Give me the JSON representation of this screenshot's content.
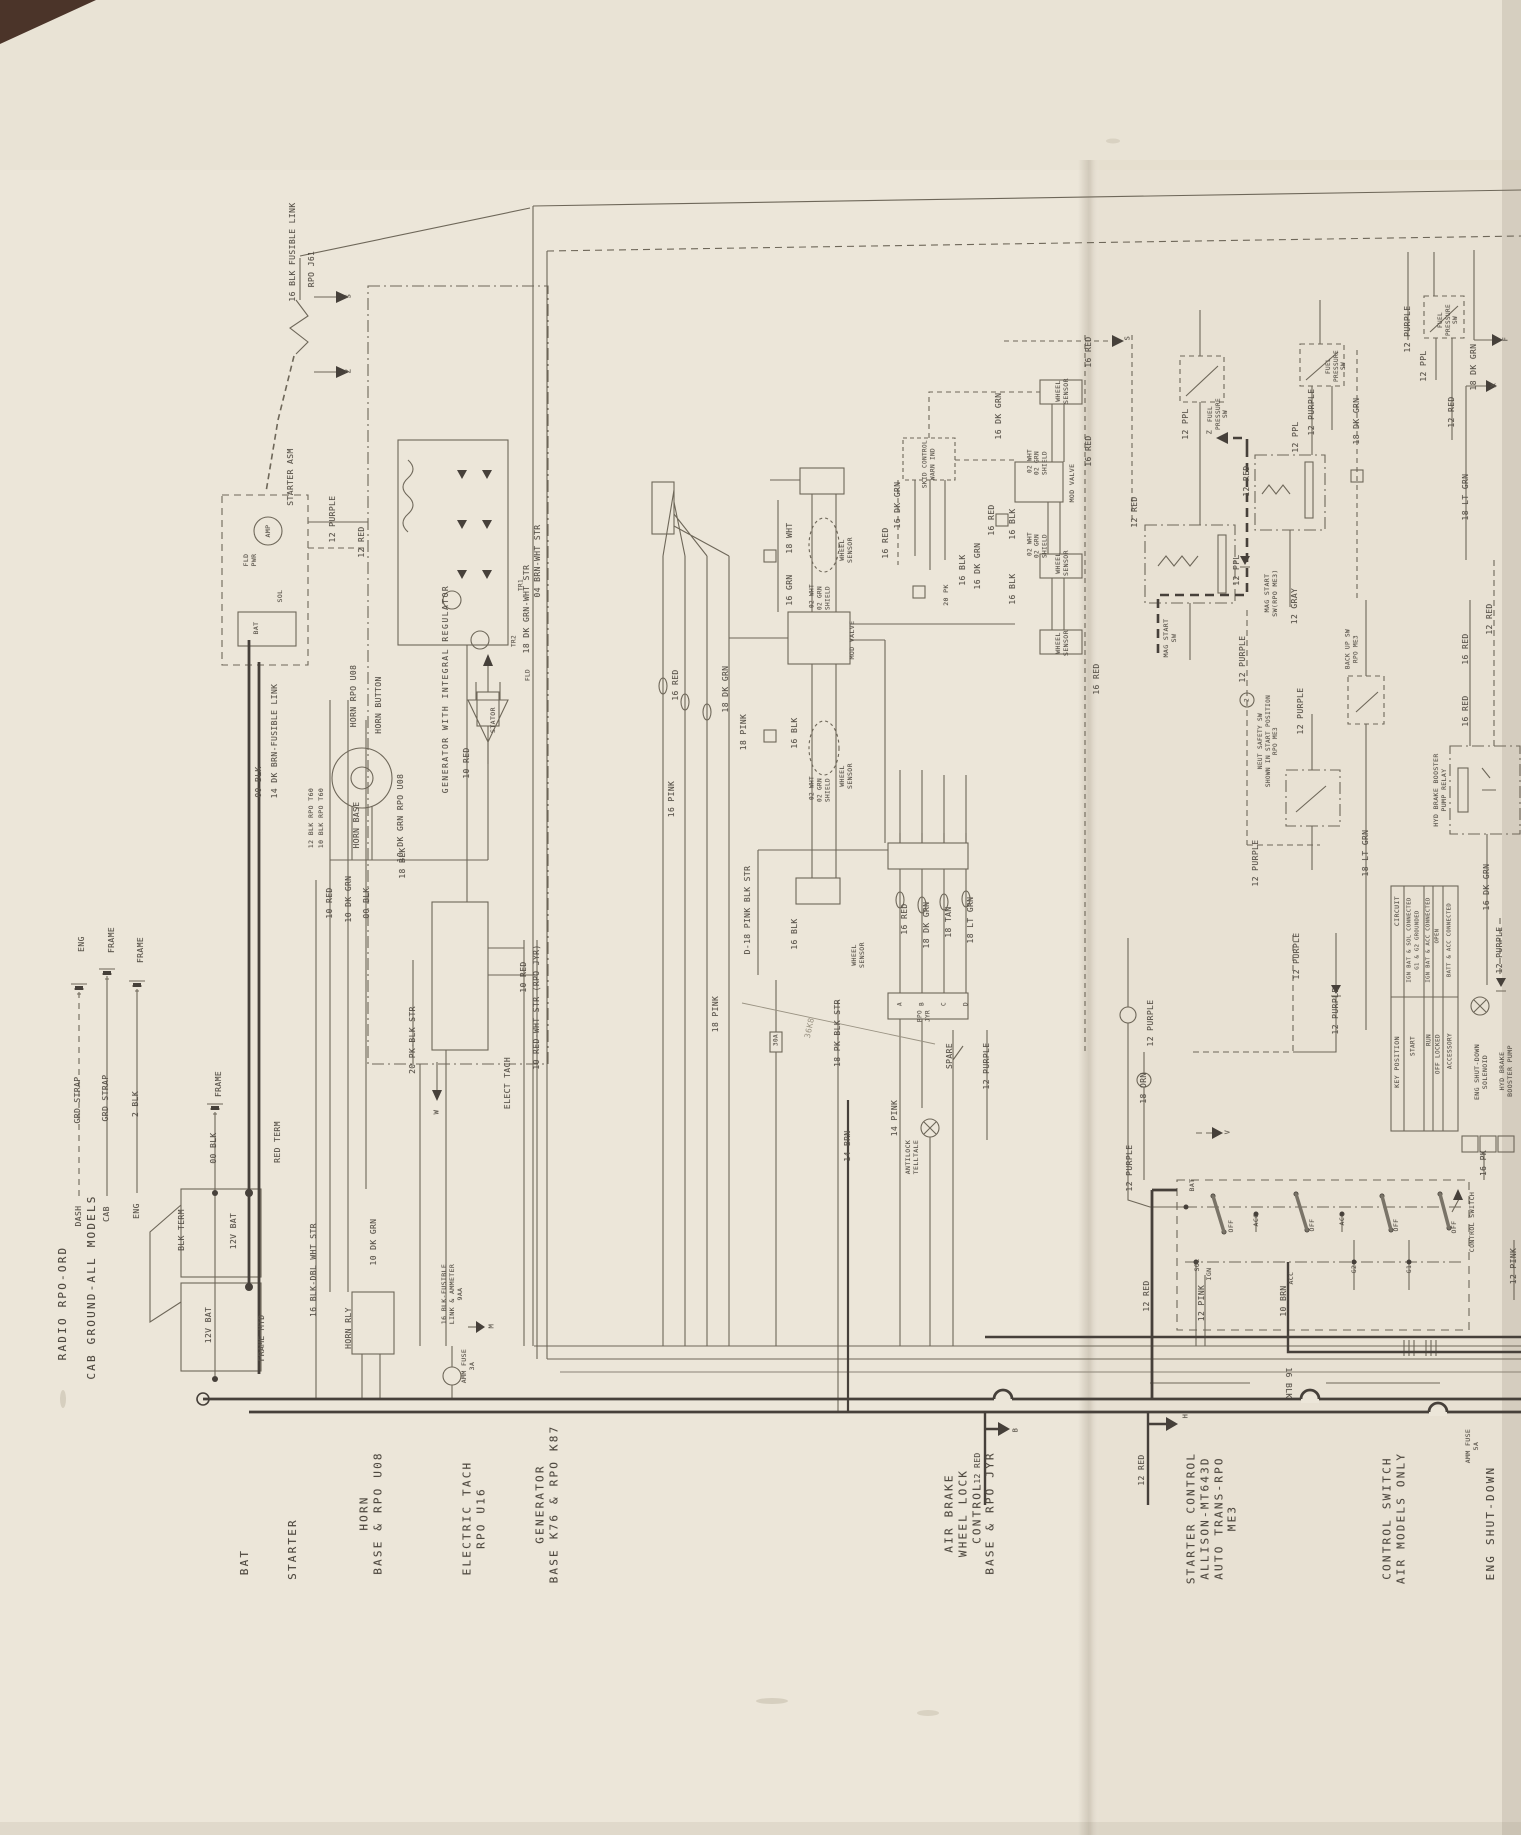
{
  "page": {
    "paper_color": "#ece6d9",
    "line_color": "#6e6759",
    "heavy_line_color": "#46403a",
    "text_color": "#59534a"
  },
  "key_table": {
    "placed_cells": [
      {
        "t": "CIRCUIT",
        "x": 1397,
        "y": 911,
        "s": 6.5,
        "n": "key-table-header"
      },
      {
        "t": "KEY POSITION",
        "x": 1397,
        "y": 1062,
        "s": 6.5,
        "n": "key-table-header"
      },
      {
        "t": "IGN BAT & SOL CONNECTED",
        "x": 1410,
        "y": 940,
        "s": 5.5,
        "n": "key-table-cell"
      },
      {
        "t": "G1 & G2 GROUNDED",
        "x": 1418,
        "y": 940,
        "s": 5.5,
        "n": "key-table-cell"
      },
      {
        "t": "START",
        "x": 1413,
        "y": 1046,
        "s": 6,
        "n": "key-table-cell"
      },
      {
        "t": "IGN BAT & ACC CONNECTED",
        "x": 1429,
        "y": 940,
        "s": 5.5,
        "n": "key-table-cell"
      },
      {
        "t": "RUN",
        "x": 1429,
        "y": 1040,
        "s": 6,
        "n": "key-table-cell"
      },
      {
        "t": "OPEN",
        "x": 1438,
        "y": 936,
        "s": 5.5,
        "n": "key-table-cell"
      },
      {
        "t": "OFF LOCKED",
        "x": 1438,
        "y": 1054,
        "s": 6,
        "n": "key-table-cell"
      },
      {
        "t": "BATT & ACC CONNECTED",
        "x": 1450,
        "y": 940,
        "s": 5.5,
        "n": "key-table-cell"
      },
      {
        "t": "ACCESSORY",
        "x": 1450,
        "y": 1051,
        "s": 6,
        "n": "key-table-cell"
      }
    ]
  },
  "labels": [
    {
      "t": "RADIO RPO-ORD",
      "x": 63,
      "y": 1303,
      "c": "big",
      "n": "section-label"
    },
    {
      "t": "CAB GROUND-ALL MODELS",
      "x": 92,
      "y": 1287,
      "c": "big",
      "n": "section-label"
    },
    {
      "t": "BAT",
      "x": 245,
      "y": 1562,
      "c": "big",
      "n": "section-label"
    },
    {
      "t": "STARTER",
      "x": 293,
      "y": 1549,
      "c": "big",
      "n": "section-label"
    },
    {
      "t": "HORN\nBASE & RPO U08",
      "x": 371,
      "y": 1513,
      "c": "big",
      "n": "section-label"
    },
    {
      "t": "ELECTRIC TACH\nRPO U16",
      "x": 474,
      "y": 1518,
      "c": "big",
      "n": "section-label"
    },
    {
      "t": "GENERATOR\nBASE K76 & RPO K87",
      "x": 547,
      "y": 1504,
      "c": "big",
      "n": "section-label"
    },
    {
      "t": "AIR BRAKE\nWHEEL LOCK\nCONTROL\nBASE & RPO JYR",
      "x": 970,
      "y": 1513,
      "c": "big",
      "n": "section-label"
    },
    {
      "t": "STARTER CONTROL\nALLISON-MT643D\nAUTO TRANS-RPO\nME3",
      "x": 1212,
      "y": 1518,
      "c": "big",
      "n": "section-label"
    },
    {
      "t": "CONTROL SWITCH\nAIR MODELS ONLY",
      "x": 1394,
      "y": 1518,
      "c": "big",
      "n": "section-label"
    },
    {
      "t": "ENG SHUT-DOWN",
      "x": 1491,
      "y": 1523,
      "c": "big",
      "n": "section-label"
    },
    {
      "t": "DASH",
      "x": 79,
      "y": 1216,
      "n": "legend-label"
    },
    {
      "t": "GRD STRAP",
      "x": 78,
      "y": 1100,
      "n": "legend-label"
    },
    {
      "t": "ENG",
      "x": 82,
      "y": 944,
      "n": "legend-label"
    },
    {
      "t": "CAB",
      "x": 107,
      "y": 1214,
      "n": "legend-label"
    },
    {
      "t": "GRD STRAP",
      "x": 106,
      "y": 1098,
      "n": "legend-label"
    },
    {
      "t": "FRAME",
      "x": 112,
      "y": 940,
      "n": "legend-label"
    },
    {
      "t": "ENG",
      "x": 137,
      "y": 1211,
      "n": "legend-label"
    },
    {
      "t": "2 BLK",
      "x": 136,
      "y": 1104,
      "n": "legend-label"
    },
    {
      "t": "FRAME",
      "x": 141,
      "y": 950,
      "n": "legend-label"
    },
    {
      "t": "00 BLK",
      "x": 214,
      "y": 1148,
      "n": "legend-label"
    },
    {
      "t": "FRAME",
      "x": 219,
      "y": 1084,
      "n": "legend-label"
    },
    {
      "t": "BLK TERM",
      "x": 182,
      "y": 1230
    },
    {
      "t": "12V BAT",
      "x": 234,
      "y": 1231
    },
    {
      "t": "12V BAT",
      "x": 209,
      "y": 1325
    },
    {
      "t": "FRAME MTD",
      "x": 262,
      "y": 1338
    },
    {
      "t": "RED TERM",
      "x": 278,
      "y": 1142
    },
    {
      "t": "10 RED",
      "x": 330,
      "y": 903
    },
    {
      "t": "10 DK GRN",
      "x": 349,
      "y": 899
    },
    {
      "t": "00 BLK",
      "x": 367,
      "y": 903
    },
    {
      "t": "16 BLK FUSIBLE LINK",
      "x": 293,
      "y": 252
    },
    {
      "t": "RPO J61",
      "x": 312,
      "y": 269
    },
    {
      "t": "STARTER ASM",
      "x": 291,
      "y": 477
    },
    {
      "t": "FLD\nPWR",
      "x": 250,
      "y": 560,
      "s": 6.5
    },
    {
      "t": "AMP",
      "x": 268,
      "y": 531,
      "s": 6.5,
      "n": "component-label"
    },
    {
      "t": "BAT",
      "x": 256,
      "y": 628,
      "s": 6.5
    },
    {
      "t": "SOL",
      "x": 280,
      "y": 596,
      "s": 6.5
    },
    {
      "t": "12 PURPLE",
      "x": 333,
      "y": 519
    },
    {
      "t": "12 RED",
      "x": 362,
      "y": 542
    },
    {
      "t": "00 BLK",
      "x": 259,
      "y": 782
    },
    {
      "t": "14 DK BRN-FUSIBLE LINK",
      "x": 275,
      "y": 741
    },
    {
      "t": "HORN RPO U08",
      "x": 354,
      "y": 696
    },
    {
      "t": "HORN BUTTON",
      "x": 379,
      "y": 705
    },
    {
      "t": "HORN BASE",
      "x": 357,
      "y": 825
    },
    {
      "t": "12 BLK RPO T60",
      "x": 311,
      "y": 818,
      "s": 6.5
    },
    {
      "t": "10 BLK RPO T60",
      "x": 321,
      "y": 818,
      "s": 6.5
    },
    {
      "t": "10 DK GRN RPO U08",
      "x": 401,
      "y": 818
    },
    {
      "t": "18 BLK",
      "x": 403,
      "y": 863
    },
    {
      "t": "GENERATOR WITH INTEGRAL REGULATOR",
      "x": 446,
      "y": 689,
      "ls": 1.5,
      "n": "component-label"
    },
    {
      "t": "TR1",
      "x": 521,
      "y": 585,
      "s": 6,
      "n": "component-label"
    },
    {
      "t": "TR2",
      "x": 514,
      "y": 641,
      "s": 6,
      "n": "component-label"
    },
    {
      "t": "FLD",
      "x": 528,
      "y": 675,
      "s": 6,
      "n": "component-label"
    },
    {
      "t": "STATOR",
      "x": 493,
      "y": 720,
      "s": 6.5,
      "n": "component-label"
    },
    {
      "t": "10 RED",
      "x": 467,
      "y": 763
    },
    {
      "t": "ELECT TACH",
      "x": 508,
      "y": 1083,
      "n": "component-label"
    },
    {
      "t": "20 PK-BLK STR",
      "x": 413,
      "y": 1040
    },
    {
      "t": "16 BLK-FUSIBLE\nLINK & AMMETER\n9AA",
      "x": 452,
      "y": 1294,
      "s": 6.5
    },
    {
      "t": "AMM FUSE\n3A",
      "x": 468,
      "y": 1366,
      "s": 6.5
    },
    {
      "t": "16 BLK-DBL WHT STR",
      "x": 314,
      "y": 1270
    },
    {
      "t": "10 DK GRN",
      "x": 374,
      "y": 1242
    },
    {
      "t": "HORN RLY",
      "x": 349,
      "y": 1328,
      "n": "component-label"
    },
    {
      "t": "18 DK GRN-WHT STR",
      "x": 527,
      "y": 609
    },
    {
      "t": "04 BRN-WHT STR",
      "x": 538,
      "y": 561
    },
    {
      "t": "D-18 PINK BLK STR",
      "x": 748,
      "y": 910
    },
    {
      "t": "16 PINK",
      "x": 672,
      "y": 799
    },
    {
      "t": "18 PINK",
      "x": 744,
      "y": 732
    },
    {
      "t": "18 PINK",
      "x": 716,
      "y": 1014
    },
    {
      "t": "16 RED",
      "x": 676,
      "y": 685
    },
    {
      "t": "18 DK GRN",
      "x": 726,
      "y": 689
    },
    {
      "t": "16 GRN",
      "x": 790,
      "y": 590
    },
    {
      "t": "18 WHT",
      "x": 790,
      "y": 538
    },
    {
      "t": "02 WHT",
      "x": 812,
      "y": 596,
      "s": 6
    },
    {
      "t": "02 GRN\nSHIELD",
      "x": 824,
      "y": 598,
      "s": 6
    },
    {
      "t": "WHEEL\nSENSOR",
      "x": 846,
      "y": 550,
      "s": 6.5,
      "n": "component-label"
    },
    {
      "t": "MOD VALVE",
      "x": 852,
      "y": 640,
      "s": 6.5,
      "n": "component-label"
    },
    {
      "t": "02 WHT",
      "x": 812,
      "y": 788,
      "s": 6
    },
    {
      "t": "02 GRN\nSHIELD",
      "x": 824,
      "y": 790,
      "s": 6
    },
    {
      "t": "WHEEL\nSENSOR",
      "x": 846,
      "y": 776,
      "s": 6.5,
      "n": "component-label"
    },
    {
      "t": "16 BLK",
      "x": 795,
      "y": 733
    },
    {
      "t": "16 BLK",
      "x": 795,
      "y": 934
    },
    {
      "t": "WHEEL\nSENSOR",
      "x": 858,
      "y": 955,
      "s": 6.5,
      "n": "component-label"
    },
    {
      "t": "16 RED",
      "x": 1089,
      "y": 451
    },
    {
      "t": "16 RED",
      "x": 1097,
      "y": 679
    },
    {
      "t": "16 RED",
      "x": 1089,
      "y": 352
    },
    {
      "t": "12 RED",
      "x": 1135,
      "y": 512
    },
    {
      "t": "16 DK GRN",
      "x": 898,
      "y": 505
    },
    {
      "t": "16 DK GRN",
      "x": 999,
      "y": 416
    },
    {
      "t": "SKID CONTROL\nWARN IND",
      "x": 929,
      "y": 464,
      "s": 6,
      "n": "component-label"
    },
    {
      "t": "20 PK",
      "x": 946,
      "y": 595,
      "s": 6.5
    },
    {
      "t": "16 BLK",
      "x": 963,
      "y": 570
    },
    {
      "t": "16 DK GRN",
      "x": 978,
      "y": 566
    },
    {
      "t": "16 RED",
      "x": 886,
      "y": 543
    },
    {
      "t": "16 RED",
      "x": 992,
      "y": 520
    },
    {
      "t": "16 BLK",
      "x": 1013,
      "y": 524
    },
    {
      "t": "16 BLK",
      "x": 1013,
      "y": 589
    },
    {
      "t": "MOD VALVE",
      "x": 1072,
      "y": 483,
      "s": 6.5,
      "n": "component-label"
    },
    {
      "t": "WHEEL\nSENSOR",
      "x": 1062,
      "y": 391,
      "s": 6.5,
      "n": "component-label"
    },
    {
      "t": "02 WHT",
      "x": 1030,
      "y": 461,
      "s": 6
    },
    {
      "t": "02 GRN\nSHIELD",
      "x": 1041,
      "y": 463,
      "s": 6
    },
    {
      "t": "02 WHT",
      "x": 1030,
      "y": 544,
      "s": 6
    },
    {
      "t": "02 GRN\nSHIELD",
      "x": 1041,
      "y": 546,
      "s": 6
    },
    {
      "t": "WHEEL\nSENSOR",
      "x": 1062,
      "y": 563,
      "s": 6.5,
      "n": "component-label"
    },
    {
      "t": "WHEEL\nSENSOR",
      "x": 1062,
      "y": 643,
      "s": 6.5,
      "n": "component-label"
    },
    {
      "t": "12 PPL",
      "x": 1186,
      "y": 424
    },
    {
      "t": "FUEL\nPRESSURE\nSW",
      "x": 1218,
      "y": 414,
      "s": 6,
      "n": "component-label"
    },
    {
      "t": "FUEL\nPRESSURE\nSW",
      "x": 1336,
      "y": 366,
      "s": 6,
      "n": "component-label"
    },
    {
      "t": "12 PURPLE",
      "x": 1312,
      "y": 412
    },
    {
      "t": "12 PPL",
      "x": 1296,
      "y": 437
    },
    {
      "t": "12 RED",
      "x": 1247,
      "y": 481
    },
    {
      "t": "MAG START\nSW",
      "x": 1170,
      "y": 638,
      "s": 6.5,
      "n": "component-label"
    },
    {
      "t": "MAG START\nSW(RPO ME3)",
      "x": 1271,
      "y": 593,
      "s": 6.5,
      "n": "component-label"
    },
    {
      "t": "12 PPL",
      "x": 1237,
      "y": 570
    },
    {
      "t": "12 GRAY",
      "x": 1295,
      "y": 606
    },
    {
      "t": "12 PURPLE",
      "x": 1301,
      "y": 711
    },
    {
      "t": "NEUT SAFETY SW\nSHOWN IN START POSITION\nRPO ME3",
      "x": 1268,
      "y": 741,
      "s": 6,
      "n": "component-label"
    },
    {
      "t": "BACK UP SW\nRPO ME3",
      "x": 1352,
      "y": 649,
      "s": 6,
      "n": "component-label"
    },
    {
      "t": "18 LT GRN",
      "x": 1366,
      "y": 853
    },
    {
      "t": "18 DK GRN",
      "x": 1357,
      "y": 421
    },
    {
      "t": "12 PURPLE",
      "x": 1256,
      "y": 863
    },
    {
      "t": "HYD BRAKE BOOSTER\nPUMP RELAY",
      "x": 1440,
      "y": 790,
      "s": 6.5,
      "n": "component-label"
    },
    {
      "t": "16 RED",
      "x": 1466,
      "y": 649
    },
    {
      "t": "16 RED",
      "x": 1466,
      "y": 711
    },
    {
      "t": "12 RED",
      "x": 1490,
      "y": 619
    },
    {
      "t": "12 PURPLE",
      "x": 1408,
      "y": 329
    },
    {
      "t": "12 PPL",
      "x": 1424,
      "y": 366
    },
    {
      "t": "12 RED",
      "x": 1452,
      "y": 412
    },
    {
      "t": "FUEL\nPRESSURE\nSW",
      "x": 1448,
      "y": 320,
      "s": 6,
      "n": "component-label"
    },
    {
      "t": "18 DK GRN",
      "x": 1474,
      "y": 367
    },
    {
      "t": "18 LT GRN",
      "x": 1466,
      "y": 497
    },
    {
      "t": "12 PURPLE",
      "x": 1243,
      "y": 659
    },
    {
      "t": "2",
      "x": 1247,
      "y": 700,
      "s": 6,
      "n": "terminal-label"
    },
    {
      "t": "12 PURPLE",
      "x": 1297,
      "y": 956
    },
    {
      "t": "12 PURPLE",
      "x": 1336,
      "y": 1011
    },
    {
      "t": "12 PURPLE",
      "x": 1151,
      "y": 1023
    },
    {
      "t": "18 ORN",
      "x": 1144,
      "y": 1088
    },
    {
      "t": "12 PURPLE",
      "x": 1130,
      "y": 1168
    },
    {
      "t": "ENG SHUT-DOWN\nSOLENOID",
      "x": 1481,
      "y": 1072,
      "s": 6.5,
      "n": "component-label"
    },
    {
      "t": "HYD BRAKE\nBOOSTER PUMP",
      "x": 1506,
      "y": 1071,
      "s": 6.5,
      "n": "component-label"
    },
    {
      "t": "16 DK GRN",
      "x": 1487,
      "y": 887
    },
    {
      "t": "12 PURPLE",
      "x": 1500,
      "y": 950
    },
    {
      "t": "SPARE",
      "x": 950,
      "y": 1056
    },
    {
      "t": "12 PURPLE",
      "x": 987,
      "y": 1066
    },
    {
      "t": "14 PINK",
      "x": 895,
      "y": 1118
    },
    {
      "t": "14 BRN",
      "x": 848,
      "y": 1146
    },
    {
      "t": "18 PK-BLK STR",
      "x": 838,
      "y": 1033
    },
    {
      "t": "ANTILOCK\nTELLTALE",
      "x": 912,
      "y": 1157,
      "s": 6.5,
      "n": "component-label"
    },
    {
      "t": "30A",
      "x": 776,
      "y": 1040,
      "s": 6,
      "n": "component-label"
    },
    {
      "t": "RPO\nJYR",
      "x": 924,
      "y": 1016,
      "s": 6
    },
    {
      "t": "A",
      "x": 900,
      "y": 1004,
      "s": 6,
      "n": "pin-label"
    },
    {
      "t": "B",
      "x": 922,
      "y": 1004,
      "s": 6,
      "n": "pin-label"
    },
    {
      "t": "C",
      "x": 944,
      "y": 1004,
      "s": 6,
      "n": "pin-label"
    },
    {
      "t": "D",
      "x": 966,
      "y": 1004,
      "s": 6,
      "n": "pin-label"
    },
    {
      "t": "16 RED",
      "x": 905,
      "y": 919
    },
    {
      "t": "18 DK GRN",
      "x": 927,
      "y": 925
    },
    {
      "t": "18 TAN",
      "x": 949,
      "y": 922
    },
    {
      "t": "18 LT GRN",
      "x": 971,
      "y": 920
    },
    {
      "t": "BAT",
      "x": 1192,
      "y": 1185,
      "s": 6.5,
      "n": "terminal-label"
    },
    {
      "t": "SOL",
      "x": 1197,
      "y": 1265,
      "s": 6.5,
      "n": "terminal-label"
    },
    {
      "t": "IGN",
      "x": 1209,
      "y": 1274,
      "s": 6.5,
      "n": "terminal-label"
    },
    {
      "t": "12 PINK",
      "x": 1202,
      "y": 1303
    },
    {
      "t": "OFF",
      "x": 1231,
      "y": 1226,
      "s": 6.5,
      "n": "terminal-label"
    },
    {
      "t": "ACC",
      "x": 1256,
      "y": 1220,
      "s": 6.5,
      "n": "terminal-label"
    },
    {
      "t": "OFF",
      "x": 1312,
      "y": 1225,
      "s": 6.5,
      "n": "terminal-label"
    },
    {
      "t": "ACC",
      "x": 1342,
      "y": 1219,
      "s": 6.5,
      "n": "terminal-label"
    },
    {
      "t": "ACC",
      "x": 1291,
      "y": 1278,
      "s": 6.5,
      "n": "terminal-label"
    },
    {
      "t": "10 BRN",
      "x": 1284,
      "y": 1301
    },
    {
      "t": "G2",
      "x": 1354,
      "y": 1269,
      "s": 6.5,
      "n": "terminal-label"
    },
    {
      "t": "OFF",
      "x": 1396,
      "y": 1225,
      "s": 6.5,
      "n": "terminal-label"
    },
    {
      "t": "G1",
      "x": 1409,
      "y": 1269,
      "s": 6.5,
      "n": "terminal-label"
    },
    {
      "t": "OFF",
      "x": 1454,
      "y": 1227,
      "s": 6.5,
      "n": "terminal-label"
    },
    {
      "t": "CONTROL SWITCH",
      "x": 1472,
      "y": 1222,
      "s": 6.5,
      "n": "component-label"
    },
    {
      "t": "16 PK",
      "x": 1484,
      "y": 1163
    },
    {
      "t": "12 PINK",
      "x": 1514,
      "y": 1266
    },
    {
      "t": "12 RED",
      "x": 1147,
      "y": 1296
    },
    {
      "t": "12 RED",
      "x": 978,
      "y": 1468
    },
    {
      "t": "12 RED",
      "x": 1142,
      "y": 1470
    },
    {
      "t": "16 BLK",
      "x": 1288,
      "y": 1383,
      "r": 90
    },
    {
      "t": "AMM FUSE\n5A",
      "x": 1472,
      "y": 1446,
      "s": 6.5
    },
    {
      "t": "36K8",
      "x": 810,
      "y": 1028,
      "r": -78,
      "c": "pencil",
      "n": "pencil-note"
    },
    {
      "t": "10 RED",
      "x": 524,
      "y": 977
    },
    {
      "t": "10 RED-WHT STR (RPO JYR)",
      "x": 537,
      "y": 1007
    },
    {
      "t": "S",
      "x": 349,
      "y": 296,
      "s": 7,
      "n": "arrow-letter"
    },
    {
      "t": "Z",
      "x": 349,
      "y": 371,
      "s": 7,
      "n": "arrow-letter"
    },
    {
      "t": "S",
      "x": 1128,
      "y": 338,
      "s": 7,
      "n": "arrow-letter"
    },
    {
      "t": "Z",
      "x": 1210,
      "y": 432,
      "s": 7,
      "n": "arrow-letter"
    },
    {
      "t": "F",
      "x": 1506,
      "y": 339,
      "s": 7,
      "n": "arrow-letter"
    },
    {
      "t": "X",
      "x": 1494,
      "y": 385,
      "s": 7,
      "n": "arrow-letter"
    },
    {
      "t": "B",
      "x": 1016,
      "y": 1430,
      "s": 7,
      "n": "arrow-letter"
    },
    {
      "t": "H",
      "x": 1186,
      "y": 1416,
      "s": 7,
      "n": "arrow-letter"
    },
    {
      "t": "V",
      "x": 1228,
      "y": 1132,
      "s": 7,
      "n": "arrow-letter"
    },
    {
      "t": "W",
      "x": 437,
      "y": 1112,
      "s": 7,
      "n": "arrow-letter"
    },
    {
      "t": "M",
      "x": 492,
      "y": 1326,
      "s": 7,
      "n": "arrow-letter"
    }
  ]
}
